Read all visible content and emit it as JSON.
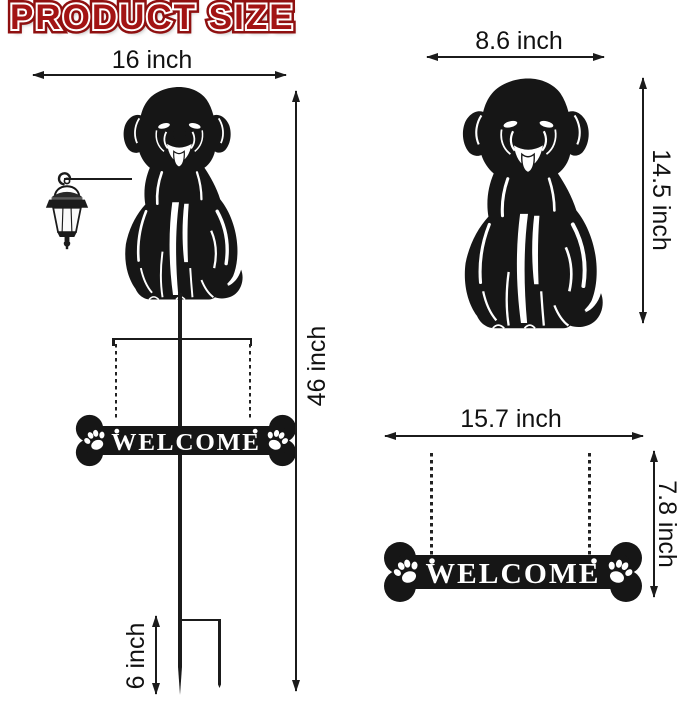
{
  "title": "PRODUCT SIZE",
  "colors": {
    "accent_red": "#a31414",
    "ink": "#1b1b1b",
    "background": "#ffffff"
  },
  "full_stake": {
    "width_label": "16 inch",
    "height_label": "46 inch",
    "ground_depth_label": "6 inch",
    "sign_text": "WELCOME"
  },
  "dog_cutout": {
    "width_label": "8.6 inch",
    "height_label": "14.5 inch"
  },
  "welcome_sign": {
    "width_label": "15.7 inch",
    "height_label": "7.8 inch",
    "sign_text": "WELCOME"
  }
}
